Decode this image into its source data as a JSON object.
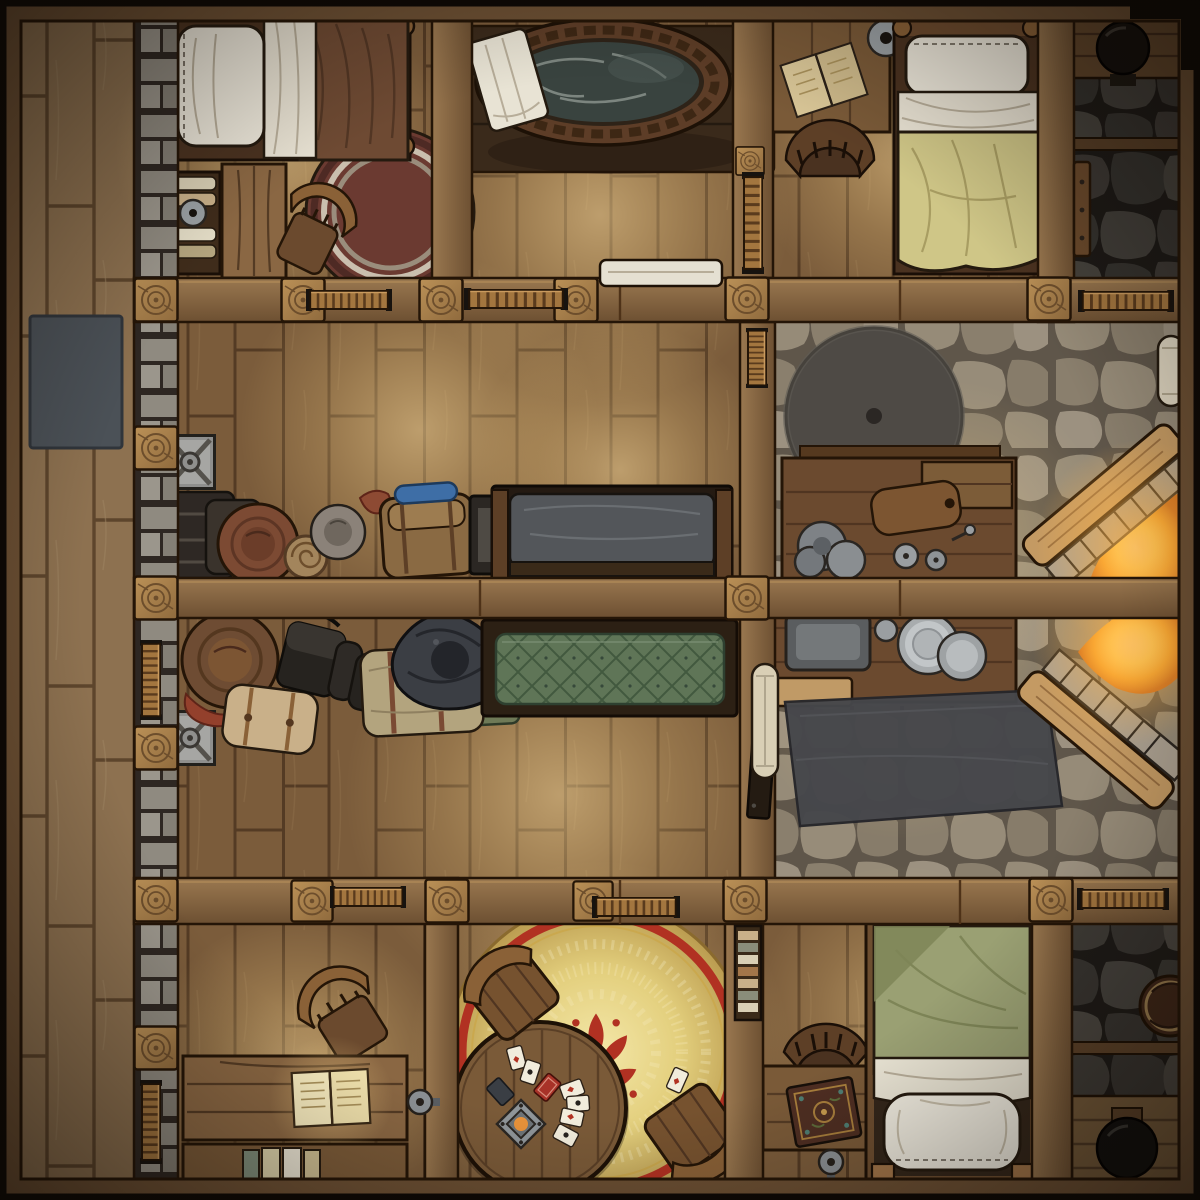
{
  "map": {
    "title": "Tavern Upper Floor - Top-Down Fantasy Battle Map",
    "view": "top-down",
    "art_style": "hand-drawn VTT battle map",
    "grid_visible": false,
    "canvas": {
      "width": 1200,
      "height": 1200
    },
    "rooms": [
      {
        "id": "bedroom-nw",
        "floor": "wood-planks",
        "furniture": [
          "single-bed-brown-blanket",
          "white-pillow",
          "bookshelf-with-books",
          "candle-dish",
          "side-table",
          "tilted-chair",
          "round-maroon-rug"
        ]
      },
      {
        "id": "bathing-room",
        "floor": "wood-planks",
        "furniture": [
          "oval-wooden-bathtub",
          "bath-water",
          "draped-white-towel",
          "dark-floor-mat",
          "towel-on-wall-rail"
        ]
      },
      {
        "id": "bedroom-ne",
        "floor": "wood-planks",
        "furniture": [
          "single-bed-yellow-blanket",
          "white-pillow",
          "writing-desk",
          "open-book",
          "hanging-candle-dish",
          "round-back-chair"
        ]
      },
      {
        "id": "chimney-chamber-ne",
        "floor": "dark-flagstone",
        "furniture": [
          "chimney-pot",
          "wood-shelf",
          "plank-door",
          "cross-beam"
        ]
      },
      {
        "id": "storage-room",
        "floor": "wood-planks",
        "furniture": [
          "metal-crate",
          "luggage-bundles",
          "brown-leather-hat",
          "rope-coil",
          "gray-hat",
          "travel-backpack",
          "blue-bedroll",
          "dark-trunk",
          "gray-padded-bench"
        ]
      },
      {
        "id": "bunk-room",
        "floor": "wood-planks",
        "furniture": [
          "metal-crate",
          "brown-hat-with-feather",
          "black-satchel",
          "boots",
          "tan-bedroll",
          "black-tricorn-hat",
          "green-quilted-bed",
          "wall-door"
        ]
      },
      {
        "id": "kitchen-forge",
        "floor": "light-flagstone",
        "furniture": [
          "grindstone-wheel",
          "north-workbench",
          "pot-stack",
          "cutting-board",
          "valve-wheels",
          "storage-box",
          "south-workbench",
          "metal-tray",
          "plate-stacks",
          "rolled-scroll",
          "large-dark-rug",
          "diagonal-fireplace-upper",
          "diagonal-fireplace-lower",
          "towel-roll"
        ]
      },
      {
        "id": "study-sw",
        "floor": "wood-planks",
        "furniture": [
          "tilted-chair",
          "writing-desk",
          "glowing-open-book",
          "book-bench",
          "standing-books",
          "door-knob"
        ]
      },
      {
        "id": "game-room",
        "floor": "wood-planks",
        "furniture": [
          "golden-round-rug",
          "red-damask-ornament",
          "round-card-table",
          "playing-cards",
          "table-lantern",
          "stool-north",
          "stool-south",
          "wall-bookshelf"
        ]
      },
      {
        "id": "bedroom-se",
        "floor": "wood-planks",
        "furniture": [
          "single-bed-green-blanket",
          "white-pillow",
          "desk",
          "ornate-tome",
          "round-back-chair",
          "door-knob"
        ]
      },
      {
        "id": "stone-corridor-se",
        "floor": "dark-flagstone",
        "furniture": [
          "barrel-top",
          "black-cauldron-pot",
          "wooden-alcove",
          "cross-beam"
        ]
      },
      {
        "id": "west-deck",
        "floor": "vertical-deck-planks",
        "furniture": [
          "gray-mat"
        ]
      }
    ],
    "structure": [
      "outer-timber-frame",
      "stone-brick-west-wall",
      "north-partition-wall",
      "middle-partition-wall",
      "south-partition-wall",
      "support-posts-with-ring-pattern",
      "railing-segments",
      "ladder-segments"
    ],
    "lighting": [
      "warm-lamplight-pools",
      "fireplace-glow",
      "dark-edge-vignette"
    ]
  },
  "palette": {
    "frame_dark": "#0f0a06",
    "wall_wood": "#8a6743",
    "wall_wood_dark": "#6d5032",
    "wall_outline": "#241507",
    "post_wood": "#b08a58",
    "floor_wood": "#7b5c3b",
    "floor_deck": "#8d7150",
    "plank_line": "#543b24",
    "stone_light": "#8f8371",
    "stone_light_gap": "#5f564a",
    "stone_dark": "#47433d",
    "stone_dark_gap": "#23201c",
    "water": "#39433f",
    "rug_gold": "#e7d583",
    "rug_red": "#b13122",
    "rug_maroon": "#6b3a31",
    "blanket_brown": "#6e4a33",
    "blanket_yellow": "#cfc687",
    "blanket_green": "#9aa073",
    "quilt_green": "#5f7557",
    "bench_gray": "#53565a",
    "linen": "#ece7da",
    "metal_gray": "#9aa0a4",
    "dark_iron": "#17130f",
    "book_page": "#f5e9bd",
    "wood_mid": "#7a5a38",
    "wood_dark_furn": "#4a3220",
    "mat_dark": "#3a2a1b",
    "rug_dark": "#46474b",
    "fire_core": "#ffe9a6",
    "fire_mid": "#f5a42c",
    "fire_deep": "#c65f17",
    "glow_warm": "#ffd98c"
  }
}
